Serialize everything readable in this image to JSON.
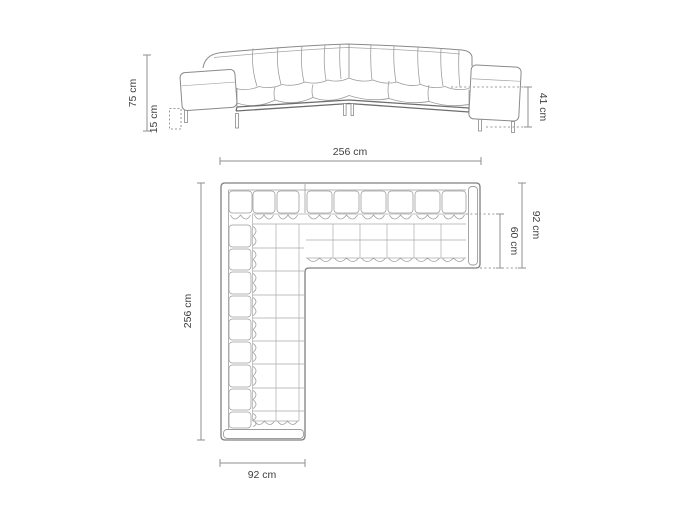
{
  "diagram": {
    "title": "corner-sofa-dimensions-diagram",
    "front_view": {
      "height_label": "75 cm",
      "leg_height_label": "15 cm",
      "seat_height_label": "41 cm"
    },
    "top_view": {
      "total_width_label": "256 cm",
      "total_depth_label": "92 cm",
      "seat_depth_label": "60 cm",
      "total_length_label": "256 cm",
      "chaise_width_label": "92 cm"
    },
    "colors": {
      "background": "#ffffff",
      "sofa_outline": "#8a8a8a",
      "sofa_detail": "#9e9e9e",
      "sofa_grid": "#ababab",
      "base_rail": "#6e6e6e",
      "dimension_line": "#8f8f8f",
      "dotted_line": "#9a9a9a",
      "label_text": "#3e3e3e"
    }
  }
}
